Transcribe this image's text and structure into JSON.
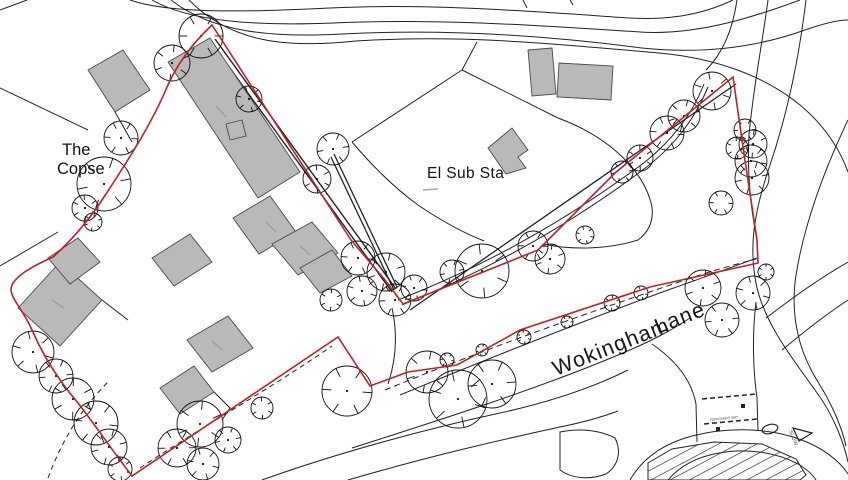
{
  "labels": {
    "the_copse_line1": "The",
    "the_copse_line2": "Copse",
    "el_sub_sta": "El Sub Sta",
    "road_wokingham": "Wokingham",
    "road_lane": "Lane",
    "road_small": "PEPPERMINT WAY",
    "marking_slow": "SLOW"
  },
  "colors": {
    "boundary": "#bf2126",
    "building_fill": "#b9b9b9",
    "building_stroke": "#4a4a4a",
    "line": "#222222",
    "background": "#ffffff"
  },
  "boundary_path": "M212,25 L351,240 L385,280 L403,304 L538,250 L615,173 L733,77 L743,147 L757,240 L758,263 L650,287 L520,330 L457,365 L408,372 L370,386 L338,337 L132,476 C112,450 95,425 78,403 C60,382 44,358 32,330 C22,308 11,299 11,289 C12,277 33,266 53,257 C72,240 87,222 100,203 C114,182 128,160 140,140 C151,121 160,104 167,87 C178,62 195,41 212,25 Z",
  "trees": [
    [
      201,
      36,
      22
    ],
    [
      172,
      63,
      18
    ],
    [
      249,
      99,
      13
    ],
    [
      333,
      149,
      16
    ],
    [
      317,
      179,
      14
    ],
    [
      358,
      258,
      17
    ],
    [
      386,
      272,
      19
    ],
    [
      362,
      291,
      15
    ],
    [
      395,
      300,
      16
    ],
    [
      331,
      300,
      11
    ],
    [
      414,
      288,
      13
    ],
    [
      452,
      272,
      12
    ],
    [
      482,
      271,
      27
    ],
    [
      533,
      246,
      15
    ],
    [
      550,
      259,
      15
    ],
    [
      585,
      235,
      9
    ],
    [
      622,
      172,
      11
    ],
    [
      640,
      158,
      13
    ],
    [
      667,
      133,
      17
    ],
    [
      684,
      116,
      16
    ],
    [
      712,
      91,
      19
    ],
    [
      745,
      130,
      11
    ],
    [
      753,
      144,
      14
    ],
    [
      751,
      161,
      16
    ],
    [
      752,
      178,
      17
    ],
    [
      737,
      148,
      11
    ],
    [
      721,
      203,
      12
    ],
    [
      703,
      288,
      18
    ],
    [
      753,
      293,
      17
    ],
    [
      722,
      320,
      17
    ],
    [
      766,
      272,
      8
    ],
    [
      447,
      360,
      7
    ],
    [
      482,
      350,
      6
    ],
    [
      524,
      337,
      7
    ],
    [
      567,
      322,
      6
    ],
    [
      612,
      303,
      8
    ],
    [
      641,
      293,
      7
    ],
    [
      104,
      184,
      27
    ],
    [
      85,
      208,
      13
    ],
    [
      121,
      138,
      17
    ],
    [
      93,
      222,
      9
    ],
    [
      33,
      352,
      21
    ],
    [
      56,
      376,
      17
    ],
    [
      73,
      399,
      21
    ],
    [
      96,
      423,
      22
    ],
    [
      109,
      447,
      18
    ],
    [
      120,
      469,
      12
    ],
    [
      177,
      448,
      19
    ],
    [
      200,
      424,
      23
    ],
    [
      203,
      464,
      16
    ],
    [
      228,
      440,
      13
    ],
    [
      262,
      408,
      11
    ],
    [
      347,
      391,
      25
    ],
    [
      427,
      372,
      21
    ],
    [
      458,
      399,
      29
    ],
    [
      492,
      384,
      24
    ]
  ],
  "buildings": [
    {
      "name": "building-small-nw",
      "points": "88,70 123,50 150,90 115,112"
    },
    {
      "name": "building-main-long",
      "points": "168,62 210,38 300,172 258,198"
    },
    {
      "name": "building-mid-1",
      "points": "233,218 270,196 296,232 259,254"
    },
    {
      "name": "building-mid-2",
      "points": "272,244 312,222 338,253 298,275"
    },
    {
      "name": "building-mid-3",
      "points": "300,268 332,250 352,276 320,293"
    },
    {
      "name": "building-copse-1",
      "points": "18,308 60,262 102,300 60,346"
    },
    {
      "name": "building-copse-1b",
      "points": "48,258 78,238 100,262 70,284"
    },
    {
      "name": "building-copse-2",
      "points": "152,258 190,234 212,262 174,286"
    },
    {
      "name": "building-copse-3",
      "points": "187,340 228,316 253,348 212,372"
    },
    {
      "name": "building-copse-4",
      "points": "160,388 194,366 214,392 180,414"
    },
    {
      "name": "building-substation",
      "points": "488,148 512,128 528,150 518,157 526,168 506,174"
    },
    {
      "name": "building-ne-1",
      "points": "528,50 552,48 556,94 532,96"
    },
    {
      "name": "building-ne-2",
      "points": "559,63 613,66 611,100 557,97"
    },
    {
      "name": "building-small-sq",
      "points": "226,124 242,120 246,136 230,140"
    }
  ]
}
